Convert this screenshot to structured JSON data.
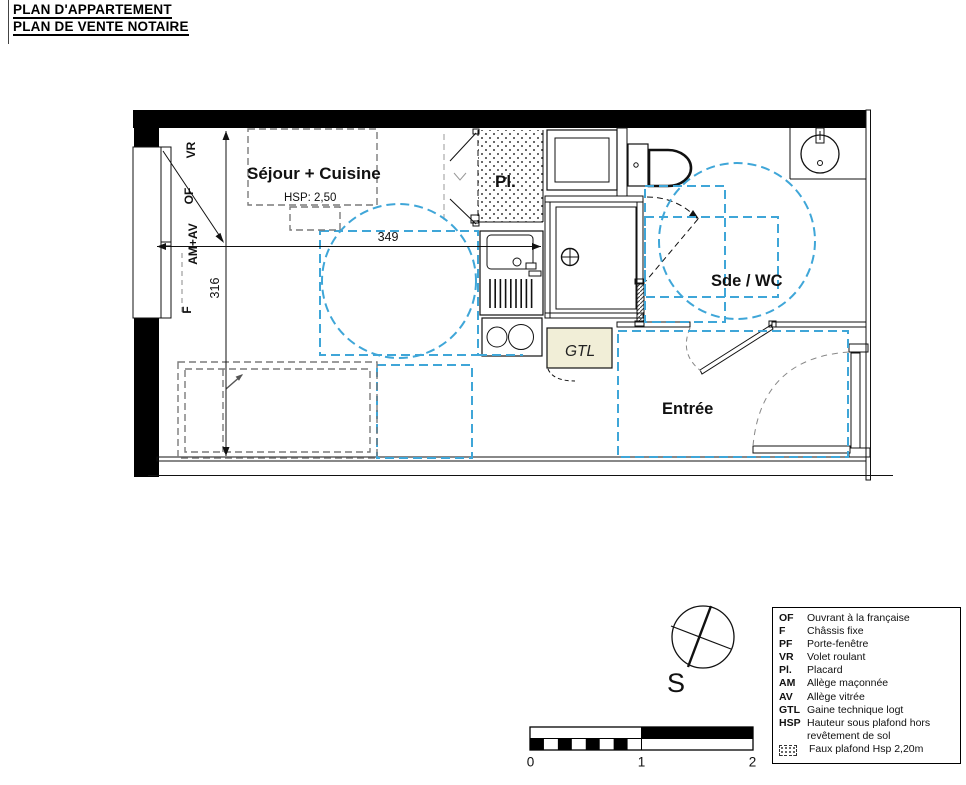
{
  "title": {
    "line1": "PLAN D'APPARTEMENT",
    "line2": "PLAN DE VENTE NOTAIRE"
  },
  "plan": {
    "labels": {
      "sejour": "Séjour + Cuisine",
      "sejour_hsp": "HSP: 2,50",
      "placard": "Pl.",
      "sde_wc": "Sde / WC",
      "entree": "Entrée",
      "gtl": "GTL"
    },
    "dims": {
      "width": "349",
      "height": "316"
    },
    "window_labels": {
      "vr": "VR",
      "of": "OF",
      "am_av": "AM+AV",
      "f": "F"
    }
  },
  "compass": {
    "south": "S"
  },
  "scale_bar": {
    "t0": "0",
    "t1": "1",
    "t2": "2"
  },
  "legend": {
    "items": [
      {
        "abbr": "OF",
        "desc": "Ouvrant à la française"
      },
      {
        "abbr": "F",
        "desc": "Châssis fixe"
      },
      {
        "abbr": "PF",
        "desc": "Porte-fenêtre"
      },
      {
        "abbr": "VR",
        "desc": "Volet roulant"
      },
      {
        "abbr": "Pl.",
        "desc": "Placard"
      },
      {
        "abbr": "AM",
        "desc": "Allège maçonnée"
      },
      {
        "abbr": "AV",
        "desc": "Allège vitrée"
      },
      {
        "abbr": "GTL",
        "desc": "Gaine technique logt"
      },
      {
        "abbr": "HSP",
        "desc": "Hauteur sous plafond hors revêtement de sol"
      }
    ],
    "faux_plafond": "Faux plafond Hsp 2,20m"
  },
  "colors": {
    "accessibility_blue": "#3FA6D8",
    "furniture_gray": "#7a7a7a",
    "gtl_fill": "#F1EED7"
  }
}
